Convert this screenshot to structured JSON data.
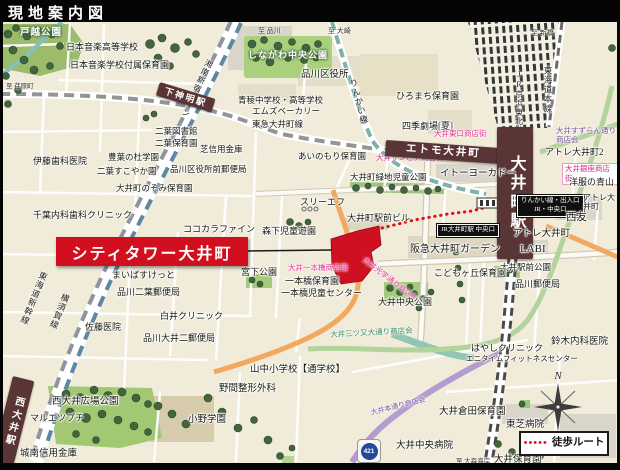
{
  "title": "現地案内図",
  "site": {
    "banner": "シティタワー大井町"
  },
  "legend": {
    "dots": "•••••",
    "label": "徒歩ルート"
  },
  "compass": {
    "n": "N"
  },
  "route_shield": "421",
  "colors": {
    "accent_red": "#d20f1e",
    "station_band": "#5a3535",
    "pink_street": "#e5368f",
    "purple_street": "#7b51a1",
    "green_street": "#2f8f63",
    "route_shield_blue": "#24489c",
    "map_background": "#f1ebd9",
    "walk_route_red": "#e01018"
  },
  "map": {
    "labels": [
      {
        "name": "label-togoshi-park",
        "text": "戸越公園",
        "x": 20,
        "y": 28,
        "style": "park",
        "fs": 9.5
      },
      {
        "name": "label-nihon-ongaku-hs",
        "text": "日本音楽高等学校",
        "x": 66,
        "y": 42,
        "style": "poi",
        "fs": 9
      },
      {
        "name": "label-nihon-ongaku-hoikuen",
        "text": "日本音楽学校付属保育園",
        "x": 70,
        "y": 60,
        "style": "poi",
        "fs": 9
      },
      {
        "name": "label-shonan-shinjuku-line",
        "text": "湘南新宿ライン",
        "x": 206,
        "y": 58,
        "style": "railv",
        "fs": 8,
        "rot": 25
      },
      {
        "name": "label-to-shinagawa",
        "text": "至 品川",
        "x": 258,
        "y": 27,
        "style": "dest",
        "fs": 7
      },
      {
        "name": "label-to-osaki",
        "text": "至 大崎",
        "x": 328,
        "y": 27,
        "style": "dest",
        "fs": 7
      },
      {
        "name": "label-to-shimbashi",
        "text": "至 新橋",
        "x": 531,
        "y": 29,
        "style": "dest",
        "fs": 7
      },
      {
        "name": "label-to-ebaramachi",
        "text": "至 荏原町",
        "x": 6,
        "y": 83,
        "style": "dest",
        "fs": 6.5
      },
      {
        "name": "label-shinagawa-chuo-park",
        "text": "しながわ中央公園",
        "x": 248,
        "y": 50,
        "style": "park",
        "fs": 9
      },
      {
        "name": "label-shinagawa-ward-office",
        "text": "品川区役所",
        "x": 301,
        "y": 70,
        "style": "poi",
        "fs": 9.5
      },
      {
        "name": "label-hiromachi-hoikuen",
        "text": "ひろまち保育園",
        "x": 396,
        "y": 91,
        "style": "poi",
        "fs": 9
      },
      {
        "name": "label-shiki-theatre",
        "text": "四季劇場[夏]",
        "x": 402,
        "y": 121,
        "style": "poi",
        "fs": 9
      },
      {
        "name": "label-tokaido-main-line",
        "text": "東海道本線",
        "x": 543,
        "y": 66,
        "style": "railv",
        "fs": 8.5
      },
      {
        "name": "label-jr-keihin-tohoku-line",
        "text": "JR京浜東北線",
        "x": 514,
        "y": 70,
        "style": "railv",
        "fs": 8
      },
      {
        "name": "label-rinkai-line",
        "text": "りんかい線",
        "x": 348,
        "y": 80,
        "style": "railv",
        "fs": 8.5,
        "rot": -15
      },
      {
        "name": "station-shimoshinmei",
        "text": "下神明駅",
        "x": 160,
        "y": 82,
        "style": "stationd",
        "fs": 9,
        "rot": 17,
        "w": 58,
        "h": 14
      },
      {
        "name": "label-seiryo-school",
        "text": "青稜中学校・高等学校",
        "x": 238,
        "y": 95,
        "style": "poi",
        "fs": 8.5
      },
      {
        "name": "label-ms-bakery",
        "text": "エムズベーカリー",
        "x": 252,
        "y": 106,
        "style": "poi",
        "fs": 8.5
      },
      {
        "name": "label-tokyu-oimachi-line",
        "text": "東急大井町線",
        "x": 252,
        "y": 119,
        "style": "poi",
        "fs": 8.5
      },
      {
        "name": "label-futaba-library",
        "text": "二葉図書館",
        "x": 155,
        "y": 126,
        "style": "poi",
        "fs": 8.5
      },
      {
        "name": "label-futaba-hoikuen",
        "text": "二葉保育園",
        "x": 155,
        "y": 138,
        "style": "poi",
        "fs": 8.5
      },
      {
        "name": "label-shiba-shinkin",
        "text": "芝信用金庫",
        "x": 200,
        "y": 144,
        "style": "poi",
        "fs": 8.5
      },
      {
        "name": "label-ito-dental",
        "text": "伊藤歯科医院",
        "x": 33,
        "y": 156,
        "style": "poi",
        "fs": 9
      },
      {
        "name": "label-hoyo-gakuen",
        "text": "豊葉の杜学園",
        "x": 108,
        "y": 152,
        "style": "poi",
        "fs": 8.5
      },
      {
        "name": "label-futaba-sukoyaka",
        "text": "二葉すこやか園",
        "x": 97,
        "y": 166,
        "style": "poi",
        "fs": 8.5
      },
      {
        "name": "label-ward-office-post",
        "text": "品川区役所前郵便局",
        "x": 170,
        "y": 164,
        "style": "poi",
        "fs": 8.5
      },
      {
        "name": "label-ainomori-hoikuen",
        "text": "あいのもり保育園",
        "x": 298,
        "y": 151,
        "style": "poi",
        "fs": 8.5
      },
      {
        "name": "label-oi-sunpia-st",
        "text": "大井サンピア商店街",
        "x": 376,
        "y": 154,
        "style": "pink",
        "fs": 7.5
      },
      {
        "name": "label-nozomi-hoikuen",
        "text": "大井町のぞみ保育園",
        "x": 116,
        "y": 183,
        "style": "poi",
        "fs": 8.5
      },
      {
        "name": "label-ryokuchi-park",
        "text": "大井町緑地児童公園",
        "x": 350,
        "y": 172,
        "style": "poi",
        "fs": 8.5
      },
      {
        "name": "station-etomo-oimachi",
        "text": "エトモ大井町",
        "x": 386,
        "y": 140,
        "style": "stationd",
        "fs": 10.5,
        "rot": 4,
        "w": 116,
        "h": 16
      },
      {
        "name": "label-oi-higashiguchi-st",
        "text": "大井東口商店街",
        "x": 434,
        "y": 130,
        "style": "pink",
        "fs": 7.5
      },
      {
        "name": "label-oi-suzuran-st",
        "text": "大井すずらん通り\n商店会",
        "x": 556,
        "y": 127,
        "style": "purple",
        "fs": 7.5
      },
      {
        "name": "label-atre-oimachi-2",
        "text": "アトレ大井町2",
        "x": 545,
        "y": 147,
        "style": "poi",
        "fs": 9
      },
      {
        "name": "label-oi-ginza-st",
        "text": "大井銀座商店街",
        "x": 562,
        "y": 163,
        "style": "pinkbox",
        "fs": 7.5
      },
      {
        "name": "label-aoyama",
        "text": "洋服の青山",
        "x": 569,
        "y": 177,
        "style": "poi",
        "fs": 9
      },
      {
        "name": "station-oimachi",
        "text": "大井町駅",
        "x": 497,
        "y": 127,
        "style": "stationv",
        "fs": 16,
        "w": 36,
        "h": 132
      },
      {
        "name": "label-ito-yokado",
        "text": "イトーヨーカドー",
        "x": 440,
        "y": 169,
        "style": "poi",
        "fs": 9.5
      },
      {
        "name": "label-chiba-clinic",
        "text": "千葉内科歯科クリニック",
        "x": 33,
        "y": 210,
        "style": "poi",
        "fs": 9
      },
      {
        "name": "label-cocokara",
        "text": "ココカラファイン",
        "x": 183,
        "y": 224,
        "style": "poi",
        "fs": 9
      },
      {
        "name": "label-three-f",
        "text": "スリーエフ",
        "x": 300,
        "y": 197,
        "style": "poi",
        "fs": 9
      },
      {
        "name": "label-morishita-park",
        "text": "森下児童遊園",
        "x": 262,
        "y": 226,
        "style": "poi",
        "fs": 9
      },
      {
        "name": "label-ekimae-bldg",
        "text": "大井町駅前ビル",
        "x": 347,
        "y": 213,
        "style": "poi",
        "fs": 9
      },
      {
        "name": "badge-rinkai-exit",
        "text": "りんかい線・出入口\nJR・中央口",
        "x": 517,
        "y": 195,
        "style": "badge",
        "fs": 6.5
      },
      {
        "name": "badge-jr-chuo-exit",
        "text": "JR大井町駅 中央口",
        "x": 437,
        "y": 224,
        "style": "badge",
        "fs": 6.5
      },
      {
        "name": "label-seiyu",
        "text": "西友",
        "x": 566,
        "y": 212,
        "style": "poi",
        "fs": 10.5
      },
      {
        "name": "label-atre-oimachi-east",
        "text": "アトレ大井町",
        "x": 583,
        "y": 193,
        "style": "poi",
        "fs": 8
      },
      {
        "name": "label-atre-oimachi",
        "text": "アトレ大井町",
        "x": 513,
        "y": 229,
        "style": "poi",
        "fs": 9.5
      },
      {
        "name": "label-labi",
        "text": "LABI",
        "x": 520,
        "y": 243,
        "style": "poi",
        "fs": 11
      },
      {
        "name": "label-hankyu-garden",
        "text": "阪急大井町ガーデン",
        "x": 410,
        "y": 244,
        "style": "poi",
        "fs": 10
      },
      {
        "name": "label-ekimae-park",
        "text": "大井駅前公園",
        "x": 500,
        "y": 262,
        "style": "poi",
        "fs": 8.5
      },
      {
        "name": "label-kodomogaoka-hoikuen",
        "text": "こどもヶ丘保育園",
        "x": 434,
        "y": 268,
        "style": "poi",
        "fs": 9
      },
      {
        "name": "label-shinagawa-post",
        "text": "品川郵便局",
        "x": 515,
        "y": 279,
        "style": "poi",
        "fs": 9
      },
      {
        "name": "label-kogaku-st",
        "text": "大井光学通り商店街",
        "x": 366,
        "y": 256,
        "style": "pink",
        "fs": 7.5,
        "rot": 38
      },
      {
        "name": "label-miyashita-park",
        "text": "宮下公園",
        "x": 241,
        "y": 267,
        "style": "poi",
        "fs": 9
      },
      {
        "name": "label-ipponbashi-st",
        "text": "大井一本橋商店街",
        "x": 288,
        "y": 264,
        "style": "pink",
        "fs": 7.5
      },
      {
        "name": "label-ipponbashi-hoikuen",
        "text": "一本橋保育園",
        "x": 285,
        "y": 276,
        "style": "poi",
        "fs": 9
      },
      {
        "name": "label-ipponbashi-center",
        "text": "一本橋児童センター",
        "x": 281,
        "y": 288,
        "style": "poi",
        "fs": 9
      },
      {
        "name": "label-maibasuketto",
        "text": "まいばすけっと",
        "x": 112,
        "y": 270,
        "style": "poi",
        "fs": 9
      },
      {
        "name": "label-futaba-post",
        "text": "品川二葉郵便局",
        "x": 117,
        "y": 287,
        "style": "poi",
        "fs": 9
      },
      {
        "name": "label-shirai-clinic",
        "text": "白井クリニック",
        "x": 160,
        "y": 311,
        "style": "poi",
        "fs": 9
      },
      {
        "name": "label-shinkansen",
        "text": "東海道新幹線",
        "x": 40,
        "y": 270,
        "style": "railv",
        "fs": 8.5,
        "rot": 22
      },
      {
        "name": "label-yokosuka-line",
        "text": "横須賀線",
        "x": 62,
        "y": 292,
        "style": "railv",
        "fs": 8.5,
        "rot": 22
      },
      {
        "name": "label-sato-clinic",
        "text": "佐藤医院",
        "x": 85,
        "y": 322,
        "style": "poi",
        "fs": 9
      },
      {
        "name": "label-oi2-post",
        "text": "品川大井二郵便局",
        "x": 143,
        "y": 333,
        "style": "poi",
        "fs": 9
      },
      {
        "name": "label-oi-chuo-park",
        "text": "大井中央公園",
        "x": 378,
        "y": 297,
        "style": "poi",
        "fs": 9
      },
      {
        "name": "label-mitsumata-st",
        "text": "大井三ツ又大通り商店会",
        "x": 330,
        "y": 331,
        "style": "green",
        "fs": 7.5,
        "rot": -3
      },
      {
        "name": "label-hayashi-clinic",
        "text": "はやしクリニック",
        "x": 471,
        "y": 343,
        "style": "poi",
        "fs": 9
      },
      {
        "name": "label-anytime-fitness",
        "text": "エニタイムフィットネスセンター",
        "x": 466,
        "y": 355,
        "style": "poi",
        "fs": 7.5
      },
      {
        "name": "label-suzuki-clinic",
        "text": "鈴木内科医院",
        "x": 551,
        "y": 337,
        "style": "poi",
        "fs": 9.5
      },
      {
        "name": "label-yamanaka-es",
        "text": "山中小学校【通学校】",
        "x": 250,
        "y": 365,
        "style": "poi",
        "fs": 9.5
      },
      {
        "name": "label-noma-seikei",
        "text": "野間整形外科",
        "x": 219,
        "y": 384,
        "style": "poi",
        "fs": 9.5
      },
      {
        "name": "label-ono-gakuen",
        "text": "小野学園",
        "x": 188,
        "y": 415,
        "style": "poi",
        "fs": 9.5
      },
      {
        "name": "station-nishioi",
        "text": "西大井駅",
        "x": 13,
        "y": 376,
        "style": "stationv",
        "fs": 10,
        "w": 22,
        "h": 88,
        "rot": 14
      },
      {
        "name": "label-nishioi-hiroba-park",
        "text": "西大井広場公園",
        "x": 52,
        "y": 397,
        "style": "poi",
        "fs": 9.5
      },
      {
        "name": "label-maruetsu-petit",
        "text": "マルエツプチ",
        "x": 30,
        "y": 413,
        "style": "poi",
        "fs": 9
      },
      {
        "name": "label-jonan-shinkin",
        "text": "城南信用金庫",
        "x": 20,
        "y": 449,
        "style": "poi",
        "fs": 9.5
      },
      {
        "name": "label-oi-hondori-st",
        "text": "大井本通り商店会",
        "x": 370,
        "y": 409,
        "style": "purple",
        "fs": 7,
        "rot": -14
      },
      {
        "name": "label-kurata-hoikuen",
        "text": "大井倉田保育園",
        "x": 439,
        "y": 407,
        "style": "poi",
        "fs": 9.5
      },
      {
        "name": "label-toshiba-hospital",
        "text": "東芝病院",
        "x": 506,
        "y": 420,
        "style": "poi",
        "fs": 9.5
      },
      {
        "name": "label-oi-chuo-hospital",
        "text": "大井中央病院",
        "x": 396,
        "y": 441,
        "style": "poi",
        "fs": 9.5
      },
      {
        "name": "label-to-omori-kaigan",
        "text": "至 大森海岸",
        "x": 456,
        "y": 458,
        "style": "dest",
        "fs": 6.5
      },
      {
        "name": "label-oi-hoikuen",
        "text": "大井保育園",
        "x": 494,
        "y": 455,
        "style": "poi",
        "fs": 9.5
      }
    ]
  }
}
